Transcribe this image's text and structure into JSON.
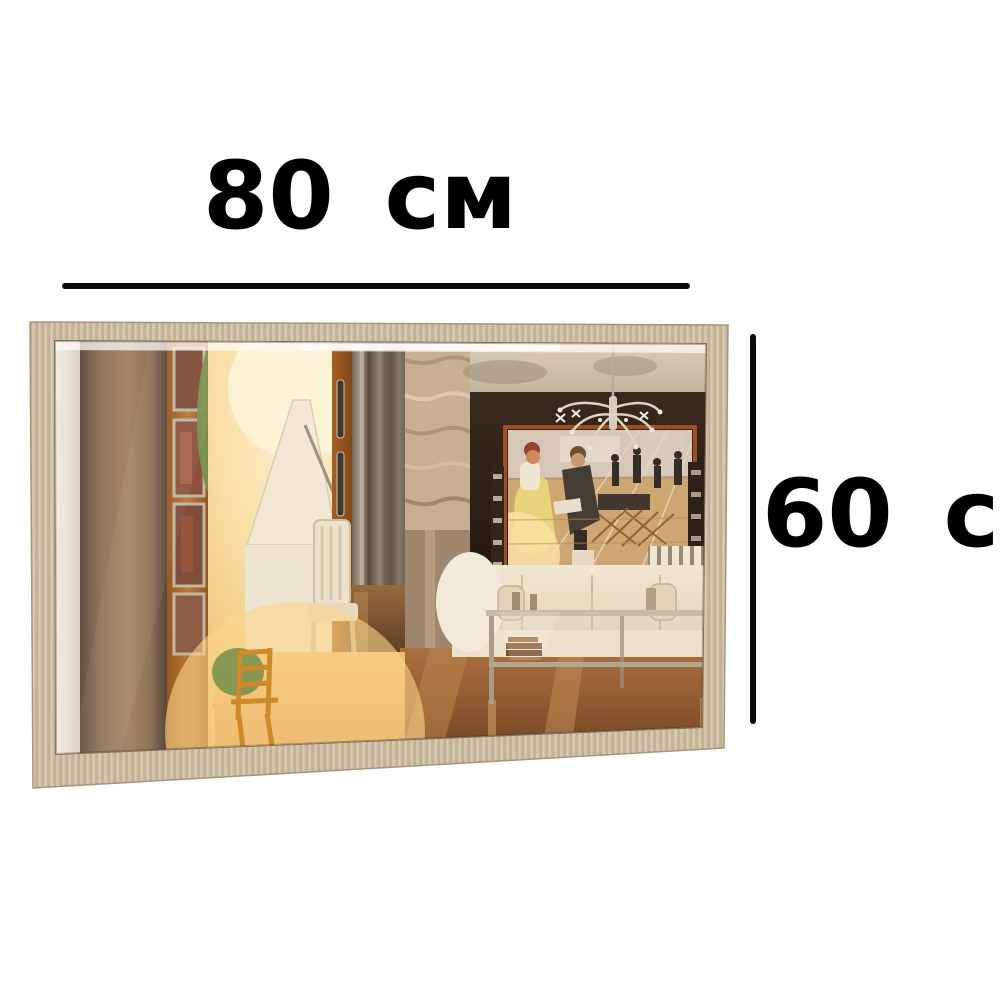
{
  "background_color": "#ffffff",
  "annotations": {
    "width": {
      "label": "80 см",
      "value": 80,
      "unit": "см"
    },
    "height": {
      "label": "60 см",
      "value": 60,
      "unit": "см"
    },
    "line_color": "#0a0a0a",
    "text_color": "#000000"
  },
  "product_image": {
    "kind": "rectangular-wall-mirror",
    "frame_color": "#cdbca1",
    "frame_grain_color": "#b7a689",
    "reflection": {
      "scene": "living-room-interior",
      "elements": [
        "white-wall-strip",
        "brown-wood-panel",
        "picture-frames-column",
        "green-plant",
        "white-grand-piano",
        "piano-chair",
        "wardrobe-door-with-handles",
        "metallic-curtain-strips",
        "marble-wall",
        "tv-screen-movie-scene",
        "crystal-chandelier",
        "white-sofas",
        "glass-console-table",
        "glossy-wooden-floor",
        "wooden-chair-in-sunlight"
      ]
    }
  }
}
